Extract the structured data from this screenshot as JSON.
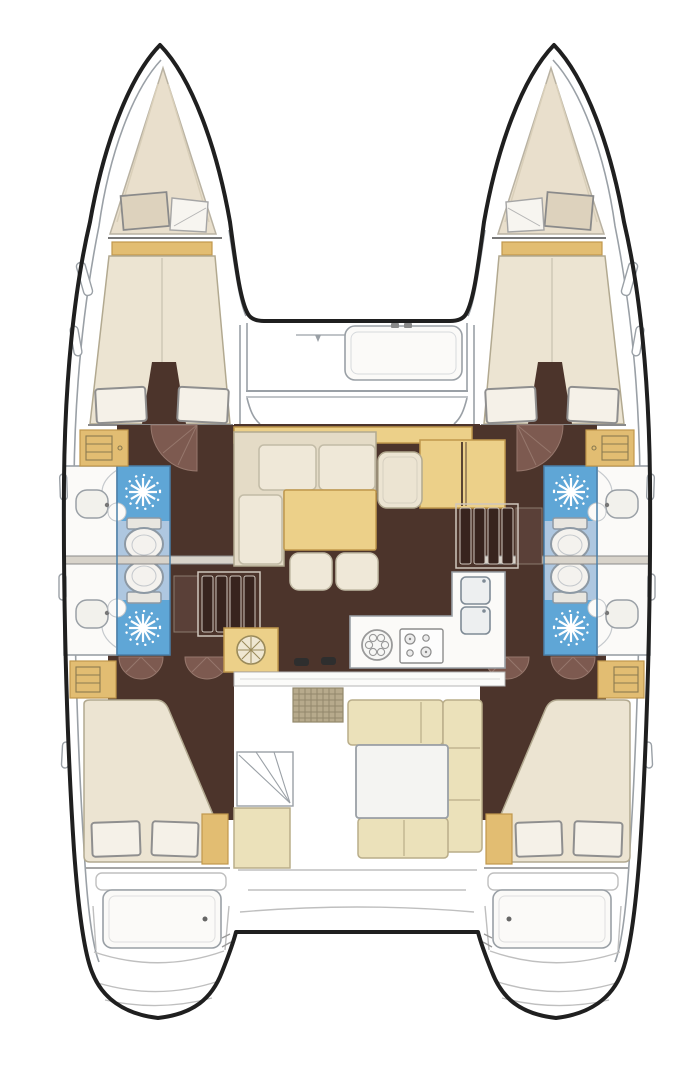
{
  "meta": {
    "type": "catamaran-interior-floor-plan",
    "view": "top-down",
    "canvas_width": 686,
    "canvas_height": 1080
  },
  "colors": {
    "page_bg": "#ffffff",
    "hull_outline": "#1f1f1f",
    "deck_line": "#9aa0a6",
    "line_gray": "#9a9a9a",
    "line_light": "#bfbfbf",
    "floor_dark": "#4c342b",
    "floor_dark2": "#38241e",
    "door_arc": "#7d5a50",
    "door_arc_edge": "#96776c",
    "forepeak": "#e9dfcc",
    "mattress": "#ece4d2",
    "mattress_edge": "#b2a990",
    "cushion": "#efe8d8",
    "cushion_edge": "#c2bba6",
    "pillow": "#f5f1e8",
    "pillow_edge": "#8f8f8f",
    "tan_strong": "#e2bd72",
    "tan_salon": "#ecd089",
    "tan_edge": "#c0984c",
    "cockpit_tan": "#ebe1ba",
    "cockpit_tan_edge": "#b9ad89",
    "shower_blue": "#5fa6d6",
    "bath_floor": "#aec7e0",
    "bath_edge": "#4a7fa8",
    "fixture_white": "#f4f2ee",
    "fixture_edge": "#8d99a4",
    "counter_white": "#fbfaf8",
    "grate": "#b7aa8c",
    "grate_line": "#93886c"
  },
  "vessel": {
    "hulls": 2,
    "double_cabins": 4,
    "bathrooms": 4,
    "showers": 4,
    "toilets": 4,
    "washbasins": 4
  },
  "features": [
    "bow-anchor-lockers",
    "foredeck-hatch",
    "forward-v-berth-port",
    "forward-v-berth-starboard",
    "bathroom-forward-port",
    "bathroom-aft-port",
    "bathroom-forward-starboard",
    "bathroom-aft-starboard",
    "saloon-l-sofa",
    "saloon-table",
    "ottomans",
    "chart-seat",
    "chart-desk",
    "galley-round-sink",
    "galley-stove",
    "galley-double-sink",
    "companionway-steps-port",
    "companionway-steps-starboard",
    "aft-double-berth-port",
    "aft-double-berth-starboard",
    "cockpit-u-seating",
    "cockpit-table",
    "cockpit-grating",
    "transom-swim-steps-port",
    "transom-swim-steps-starboard"
  ]
}
